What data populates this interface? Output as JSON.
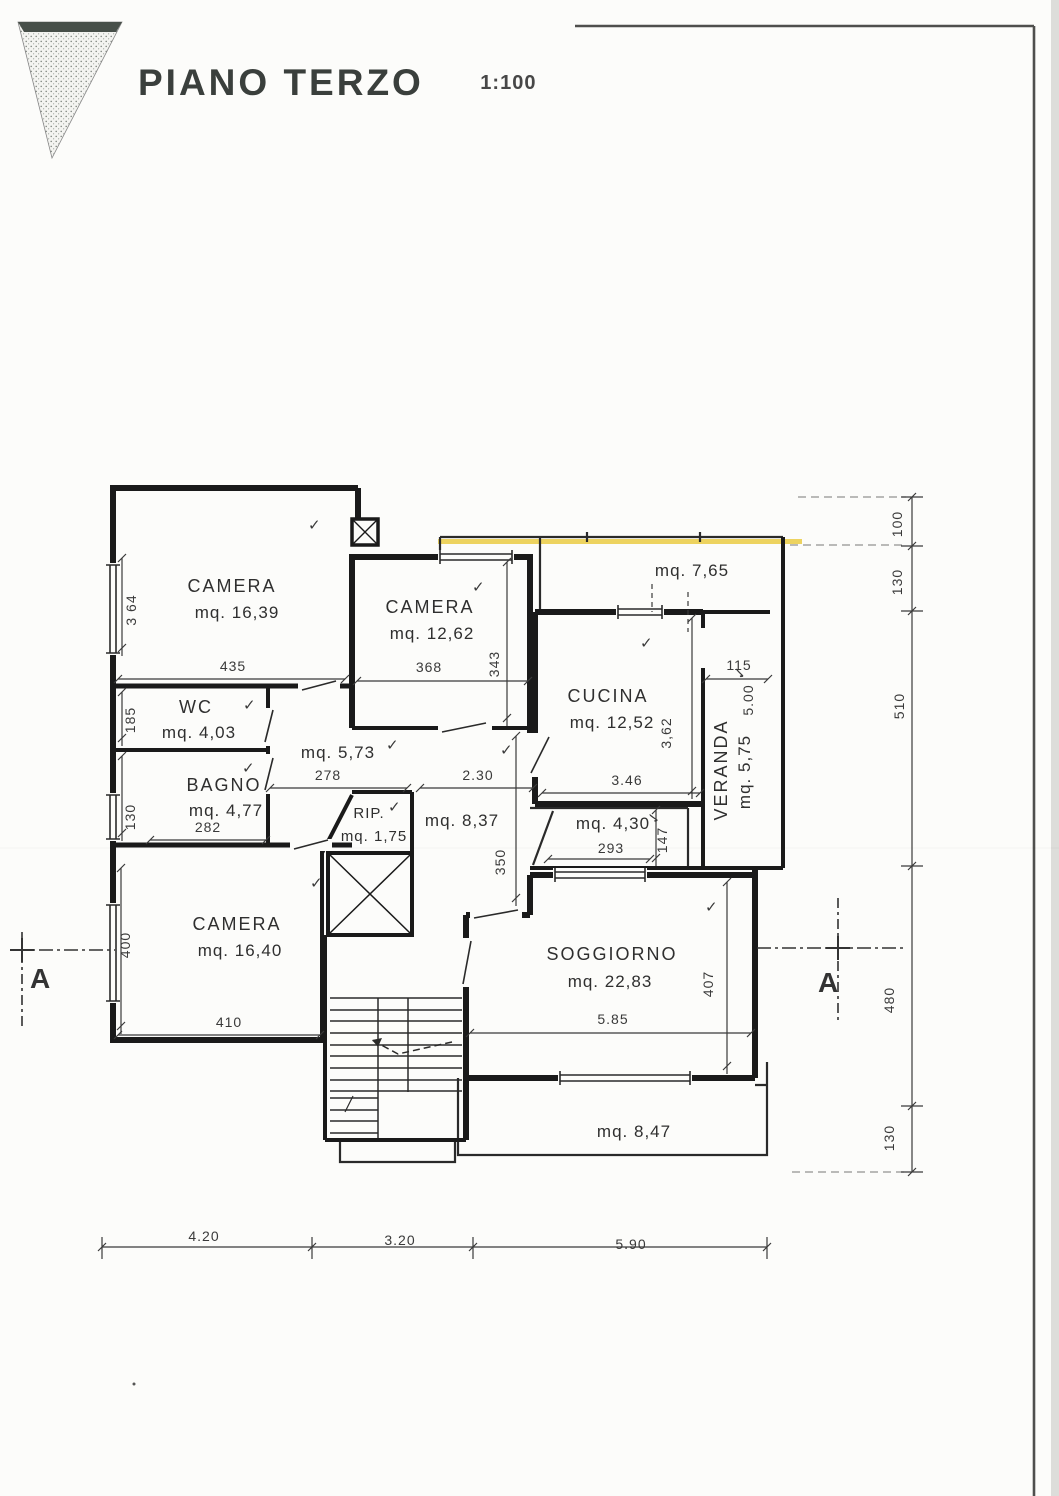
{
  "title": {
    "text": "PIANO TERZO",
    "scale": "1:100"
  },
  "rooms": [
    {
      "label": "CAMERA",
      "area": "mq. 16,39"
    },
    {
      "label": "CAMERA",
      "area": "mq. 12,62"
    },
    {
      "label": "CUCINA",
      "area": "mq. 12,52"
    },
    {
      "label": "VERANDA",
      "area": "mq. 5,75"
    },
    {
      "label": "WC",
      "area": "mq. 4,03"
    },
    {
      "label": "BAGNO",
      "area": "mq. 4,77"
    },
    {
      "label": "RIP.",
      "area": "mq. 1,75"
    },
    {
      "label": "CAMERA",
      "area": "mq. 16,40"
    },
    {
      "label": "SOGGIORNO",
      "area": "mq. 22,83"
    },
    {
      "label": "",
      "area": "mq. 5,73"
    },
    {
      "label": "",
      "area": "mq. 8,37"
    },
    {
      "label": "",
      "area": "mq. 4,30"
    },
    {
      "label": "",
      "area": "mq. 7,65"
    },
    {
      "label": "",
      "area": "mq. 8,47"
    }
  ],
  "dims": {
    "d435": "435",
    "d368": "368",
    "d343": "343",
    "d364": "3 64",
    "d185": "185",
    "d130a": "130",
    "d282": "282",
    "d278": "278",
    "d230": "2.30",
    "d350": "350",
    "d346": "3.46",
    "d362": "3,62",
    "d115": "115",
    "d500": "5.00",
    "d293": "293",
    "d147": "147",
    "d410": "410",
    "d400": "400",
    "d585": "5.85",
    "d407": "407",
    "d420": "4.20",
    "d320": "3.20",
    "d590": "5.90",
    "r100": "100",
    "r130a": "130",
    "r510": "510",
    "r480": "480",
    "r130b": "130"
  },
  "section": {
    "label": "A"
  },
  "glyphs": {
    "check": "✓"
  },
  "colors": {
    "ink": "#2f2f2f",
    "wall": "#1a1a1a",
    "highlight": "#e8c838",
    "paper": "#fcfcfa",
    "frame": "#4f4f4d"
  }
}
